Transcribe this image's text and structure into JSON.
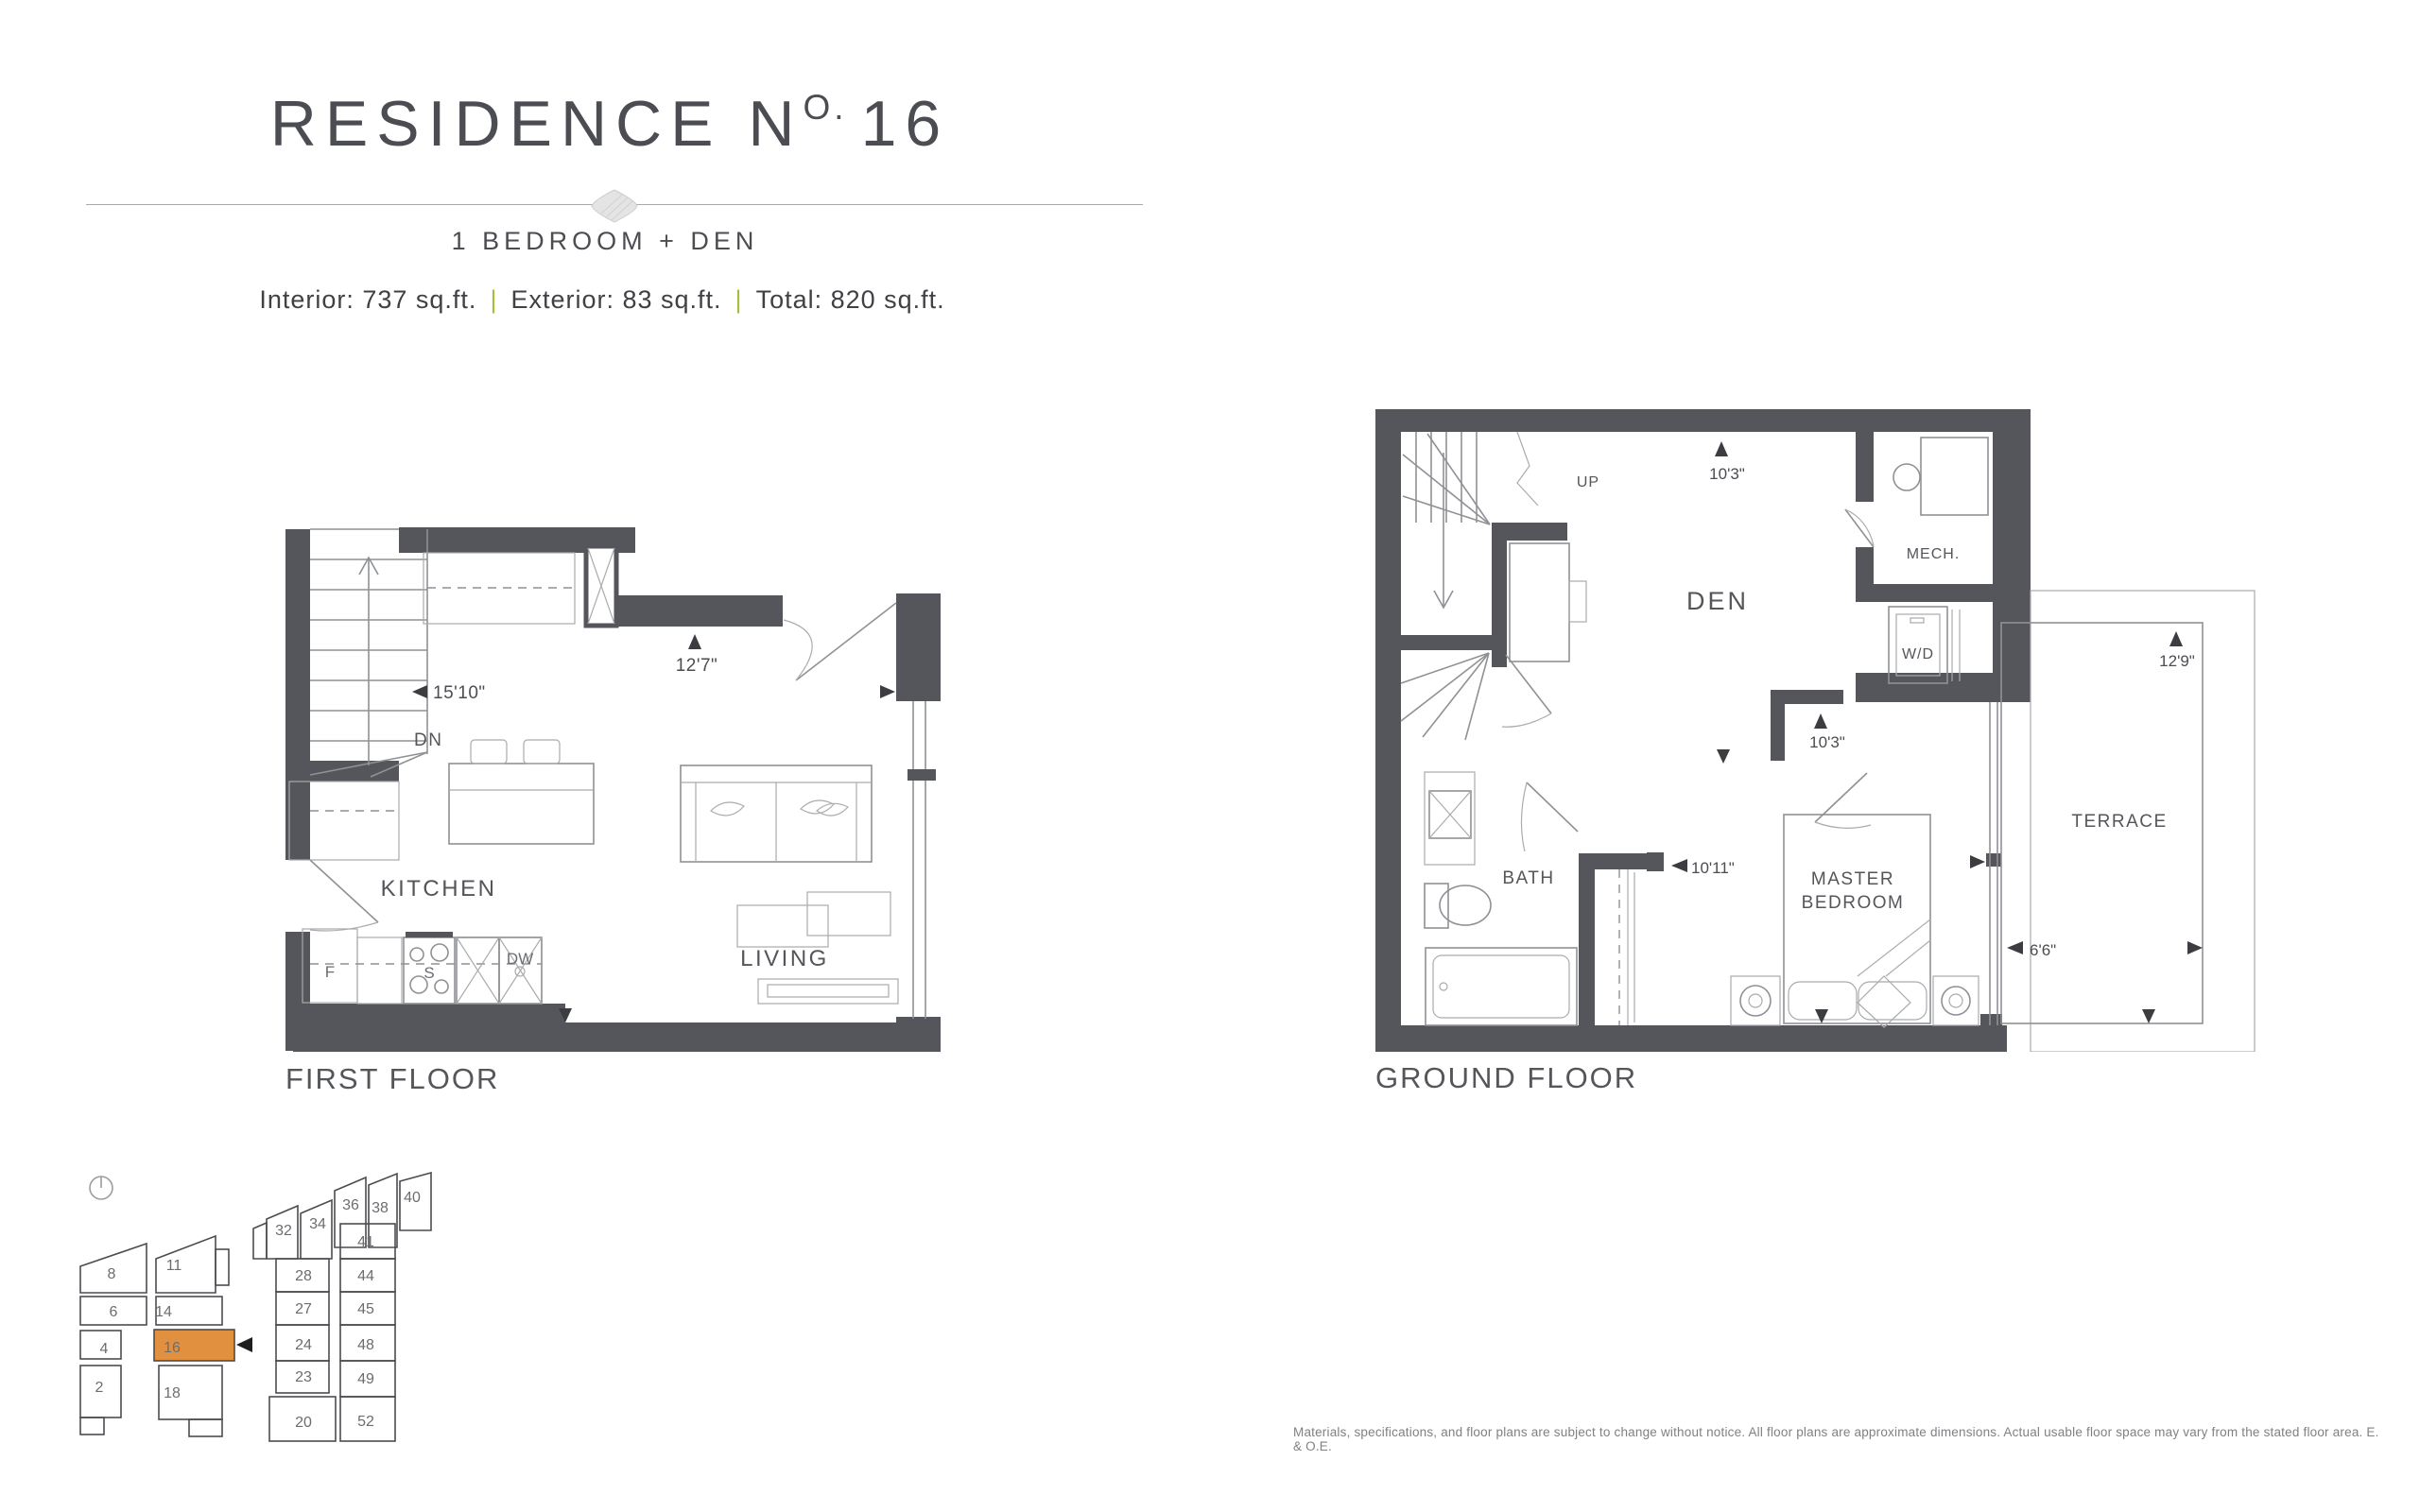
{
  "header": {
    "title": {
      "prefix": "RESIDENCE N",
      "sup": "O.",
      "number": "16"
    },
    "subtitle": "1 BEDROOM + DEN",
    "stats": {
      "interior": "Interior: 737 sq.ft.",
      "exterior": "Exterior: 83 sq.ft.",
      "total": "Total: 820 sq.ft.",
      "separator": "|",
      "separator_color": "#A6BE39"
    }
  },
  "first_floor": {
    "title": "FIRST FLOOR",
    "rooms": {
      "kitchen": "KITCHEN",
      "living": "LIVING"
    },
    "fixtures": {
      "fridge": "F",
      "stove": "S",
      "dishwasher": "DW",
      "down": "DN"
    },
    "dimensions": {
      "width": "15'10\"",
      "depth": "12'7\""
    }
  },
  "ground_floor": {
    "title": "GROUND FLOOR",
    "rooms": {
      "den": "DEN",
      "mech": "MECH.",
      "laundry": "W/D",
      "bath": "BATH",
      "master_line1": "MASTER",
      "master_line2": "BEDROOM",
      "terrace": "TERRACE"
    },
    "fixtures": {
      "up": "UP"
    },
    "dimensions": {
      "den_width": "10'3\"",
      "bedroom_width": "10'3\"",
      "bedroom_depth": "10'11\"",
      "terrace_depth": "12'9\"",
      "terrace_width": "6'6\""
    }
  },
  "keyplan": {
    "highlight_color": "#E1903F",
    "highlighted": "16",
    "units": [
      "8",
      "11",
      "6",
      "14",
      "4",
      "16",
      "2",
      "18",
      "32",
      "34",
      "36",
      "38",
      "40",
      "41",
      "28",
      "44",
      "27",
      "45",
      "24",
      "48",
      "23",
      "49",
      "20",
      "52"
    ]
  },
  "disclaimer": "Materials, specifications, and floor plans are subject to change without notice. All floor plans are approximate dimensions. Actual usable floor space may vary from the stated floor area. E. & O.E."
}
